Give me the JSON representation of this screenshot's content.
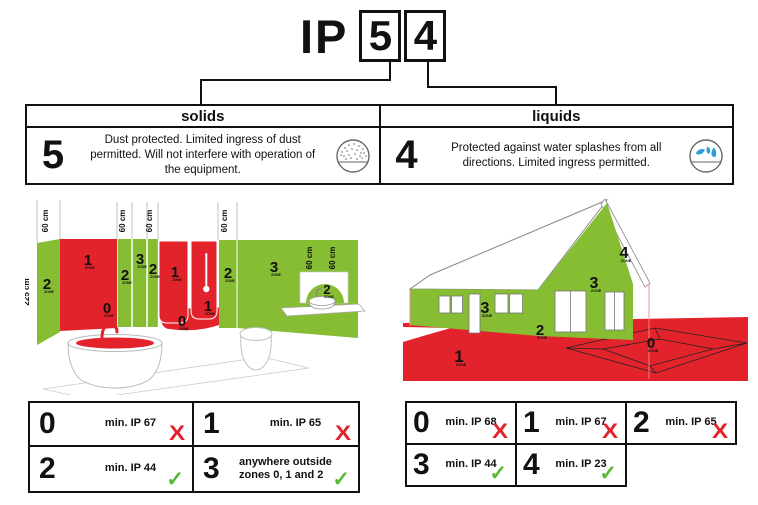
{
  "title": {
    "prefix": "IP",
    "solids_digit": "5",
    "liquids_digit": "4"
  },
  "ratings": {
    "solids": {
      "header": "solids",
      "digit": "5",
      "description": "Dust protected. Limited ingress of dust permitted. Will not interfere with operation of the equipment.",
      "icon": "dust-circle-icon"
    },
    "liquids": {
      "header": "liquids",
      "digit": "4",
      "description": "Protected against water splashes from all directions. Limited ingress permitted.",
      "icon": "water-splash-icon"
    }
  },
  "zone_caption": "ZONE",
  "bathroom": {
    "height_label": "225 cm",
    "measure_label": "60 cm",
    "zone_labels": [
      "2",
      "1",
      "0",
      "2",
      "3",
      "2",
      "1",
      "1",
      "0",
      "2",
      "3",
      "2"
    ]
  },
  "house": {
    "zone_labels": [
      "1",
      "2",
      "3",
      "3",
      "4",
      "0"
    ]
  },
  "tables": {
    "bathroom": {
      "cells": [
        {
          "zone": "0",
          "requirement": "min. IP 67",
          "allowed": false
        },
        {
          "zone": "1",
          "requirement": "min. IP 65",
          "allowed": false
        },
        {
          "zone": "2",
          "requirement": "min. IP 44",
          "allowed": true
        },
        {
          "zone": "3",
          "requirement": "anywhere outside zones 0, 1 and 2",
          "allowed": true
        }
      ]
    },
    "outdoor": {
      "cells": [
        {
          "zone": "0",
          "requirement": "min. IP 68",
          "allowed": false
        },
        {
          "zone": "1",
          "requirement": "min. IP 67",
          "allowed": false
        },
        {
          "zone": "2",
          "requirement": "min. IP 65",
          "allowed": false
        },
        {
          "zone": "3",
          "requirement": "min. IP 44",
          "allowed": true
        },
        {
          "zone": "4",
          "requirement": "min. IP 23",
          "allowed": true
        }
      ]
    }
  },
  "marks": {
    "pass": "✓",
    "fail": "X"
  },
  "colors": {
    "zone_red": "#E3232B",
    "zone_green": "#86BD33",
    "pass_green": "#54B934",
    "fail_red": "#E3232B",
    "water_blue": "#2E9FD8"
  }
}
